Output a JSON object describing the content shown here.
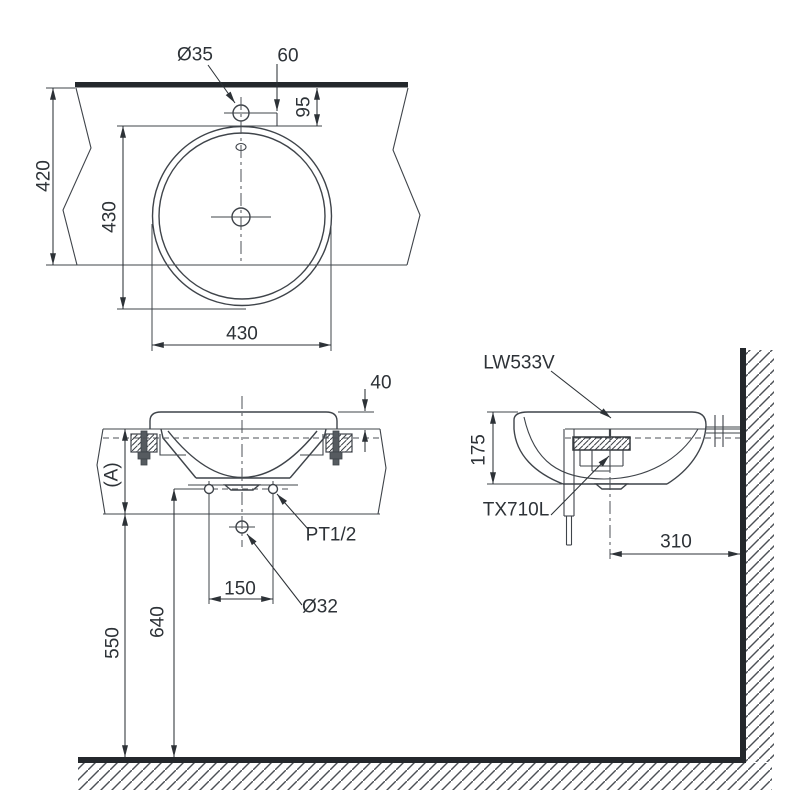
{
  "colors": {
    "background": "#ffffff",
    "line": "#3f444a",
    "heavy_line": "#24282c",
    "text": "#2d3237"
  },
  "plan_view": {
    "dims": {
      "faucet_hole_diameter": "Ø35",
      "faucet_center_to_wall": "60",
      "basin_edge_to_wall": "95",
      "counter_depth": "420",
      "basin_diameter_depth": "430",
      "basin_diameter_width": "430"
    }
  },
  "front_view": {
    "dims": {
      "rim_above_counter": "40",
      "counter_thickness": "(A)",
      "supply_connection": "PT1/2",
      "supply_hole_spacing": "150",
      "waste_hole_diameter": "Ø32",
      "supply_height_from_floor": "640",
      "counter_underside_from_floor": "550"
    }
  },
  "side_view": {
    "labels": {
      "basin_model": "LW533V",
      "drain_model": "TX710L"
    },
    "dims": {
      "basin_height": "175",
      "drain_center_to_wall": "310"
    }
  }
}
